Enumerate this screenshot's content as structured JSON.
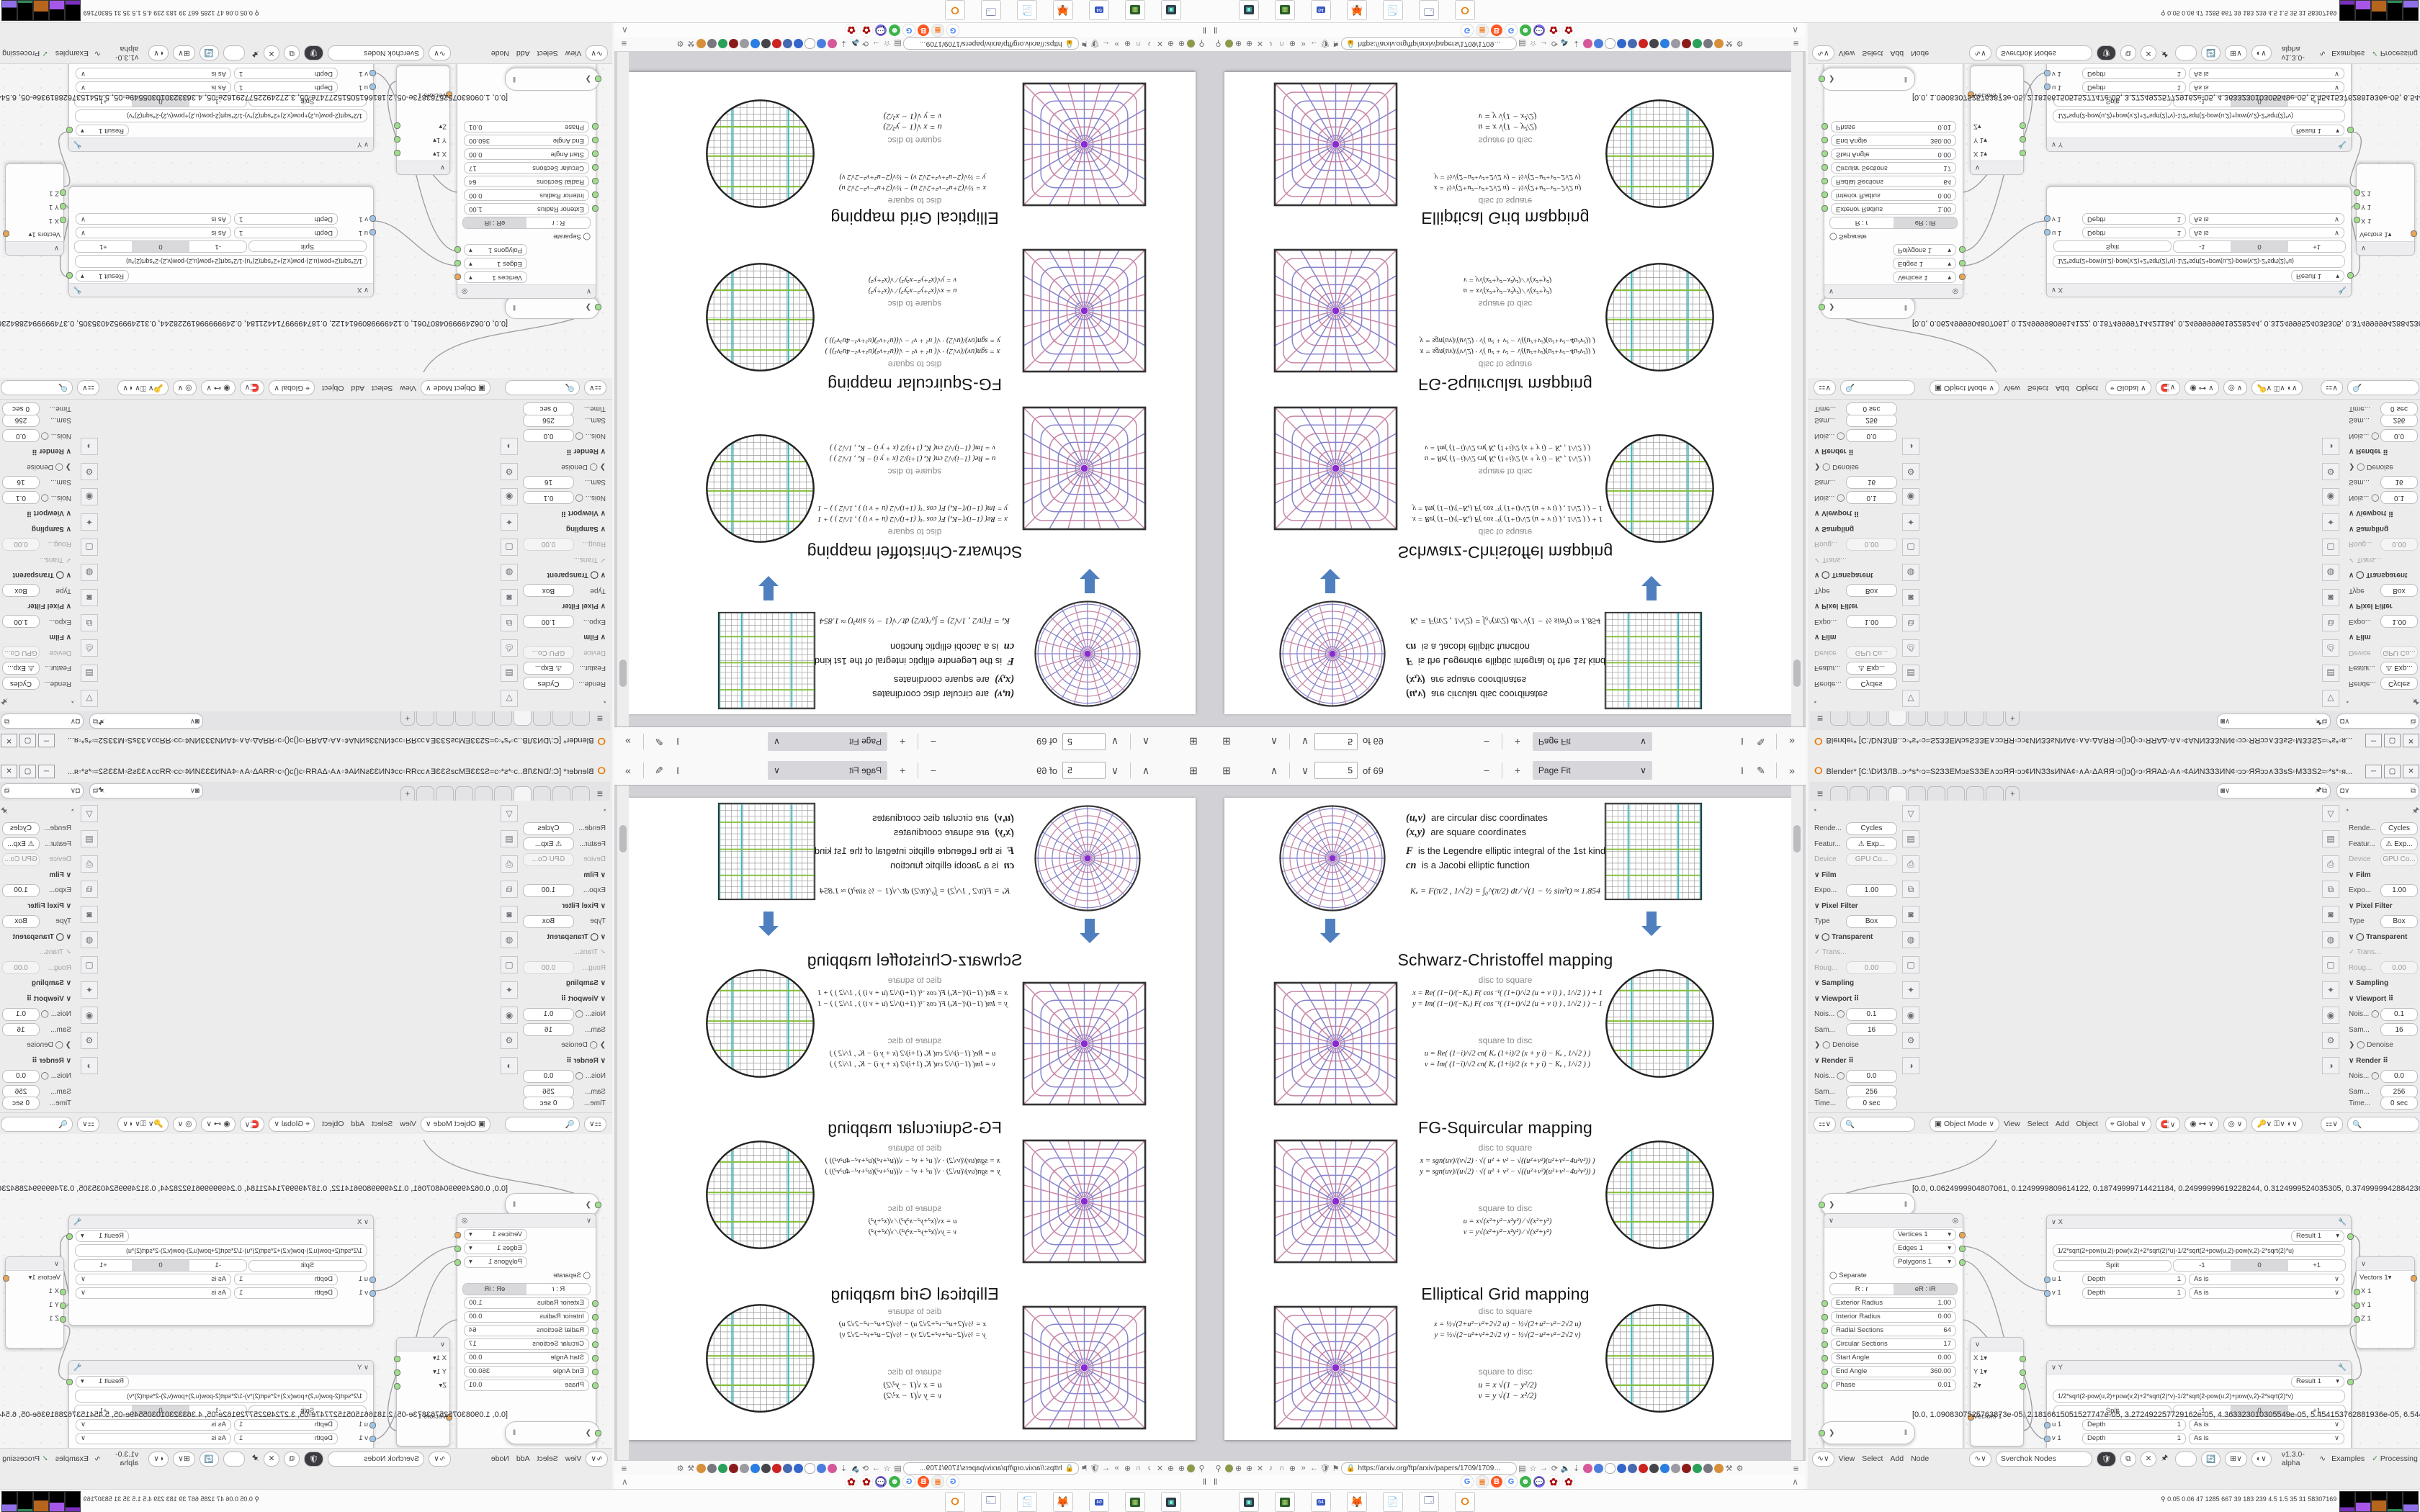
{
  "pdf": {
    "toolbar": {
      "page_value": "5",
      "page_of": "of 69",
      "zoom_label": "Page Fit"
    },
    "page": {
      "legend": [
        {
          "sym": "(u,v)",
          "text": "are circular disc coordinates"
        },
        {
          "sym": "(x,y)",
          "text": "are square coordinates"
        },
        {
          "sym": "F",
          "text": "is the Legendre elliptic integral of the 1st kind"
        },
        {
          "sym": "cn",
          "text": "is a Jacobi elliptic function"
        }
      ],
      "ke_equation": "Kₑ = F(π/2 , 1/√2) = ∫₀^(π/2) dt ∕ √(1 − ½ sin²t)  ≈ 1.854",
      "sections": [
        {
          "title": "Schwarz-Christoffel mapping",
          "d2s_label": "disc to square",
          "s2d_label": "square to disc",
          "eq1": "x = Re( (1−i)/(−Kₑ) F( cos⁻¹( (1+i)/√2 (u + v i) ) , 1/√2 ) ) + 1",
          "eq2": "y = Im( (1−i)/(−Kₑ) F( cos⁻¹( (1+i)/√2 (u + v i) ) , 1/√2 ) ) − 1",
          "eq3": "u = Re( (1−i)/√2 cn( Kₑ (1+i)/2 (x + y i) − Kₑ , 1/√2 ) )",
          "eq4": "v = Im( (1−i)/√2 cn( Kₑ (1+i)/2 (x + y i) − Kₑ , 1/√2 ) )"
        },
        {
          "title": "FG-Squircular mapping",
          "d2s_label": "disc to square",
          "s2d_label": "square to disc",
          "eq1": "x = sgn(uv)/(v√2) · √( u² + v² − √((u²+v²)(u²+v²−4u²v²)) )",
          "eq2": "y = sgn(uv)/(u√2) · √( u² + v² − √((u²+v²)(u²+v²−4u²v²)) )",
          "eq3": "u = x√(x²+y²−x²y²) ∕ √(x²+y²)",
          "eq4": "v = y√(x²+y²−x²y²) ∕ √(x²+y²)"
        },
        {
          "title": "Elliptical Grid mapping",
          "d2s_label": "disc to square",
          "s2d_label": "square to disc",
          "eq1": "x = ½√(2+u²−v²+2√2 u) − ½√(2+u²−v²−2√2 u)",
          "eq2": "y = ½√(2−u²+v²+2√2 v) − ½√(2−u²+v²−2√2 v)",
          "eq3": "u = x √(1 − y²/2)",
          "eq4": "v = y √(1 − x²/2)"
        }
      ]
    },
    "navbar": {
      "url": "https://arxiv.org/ftp/arxiv/papers/1709/1709…"
    }
  },
  "blender": {
    "title": "Blender* [C:\\DИЗЛВ..ɔ◦*ѕ*◦ɔ≈S2ЗЗEМɔƨЅЗЗE∧ɔɔЯЯ◦ɔɔ¢ИΝЗЗѕИΝΑ¢◦∧Α◦ΔΑЯЯ◦ɔ()ɔ()◦ɔ◦ЯЯΑΔ◦Α∧◦¢ΑИΝЗЗЗИΝ¢◦ɔɔ◦ЯЯɔɔ∧ЗЗѕЅ◦МЗЗЅ2≈◦*ѕ*◦я...",
    "props": {
      "rows": [
        {
          "label": "Rende...",
          "value": "Cycles"
        },
        {
          "label": "Featur...",
          "value": "⚠ Exp..."
        },
        {
          "label": "Device",
          "value": "GPU Co..."
        },
        {
          "label": "∨ Film",
          "value": ""
        },
        {
          "label": "Expo...",
          "value": "1.00"
        },
        {
          "label": "∨ Pixel Filter",
          "value": ""
        },
        {
          "label": "Type",
          "value": "Box"
        },
        {
          "label": "∨ ◯ Transparent",
          "value": ""
        },
        {
          "label": "✓ Trans...",
          "value": ""
        },
        {
          "label": "Roug...",
          "value": "0.00"
        },
        {
          "label": "∨ Sampling",
          "value": ""
        },
        {
          "label": "∨ Viewport  ⠿",
          "value": ""
        },
        {
          "label": "Nois... ◯",
          "value": "0.1"
        },
        {
          "label": "Sam...",
          "value": "16"
        },
        {
          "label": "❯ ◯ Denoise",
          "value": ""
        },
        {
          "label": "∨ Render  ⠿",
          "value": ""
        },
        {
          "label": "Nois... ◯",
          "value": "0.0"
        },
        {
          "label": "Sam...",
          "value": "256"
        },
        {
          "label": "Time...",
          "value": "0 sec"
        }
      ]
    },
    "viewport": {
      "overlay1": "Top Orthographic",
      "overlay2": "(2) Scene Collection | ◎ ▦◌◯◌◯◎◌◯◌▦ ◎",
      "stats": [
        {
          "k": "Objects",
          "v": "0 / 53"
        },
        {
          "k": "Vertices",
          "v": "0"
        },
        {
          "k": "Edges",
          "v": "0"
        },
        {
          "k": "Faces",
          "v": "0"
        },
        {
          "k": "Triangles",
          "v": "0"
        }
      ]
    },
    "vp_header": {
      "mode": "Object Mode",
      "menu_view": "View",
      "menu_select": "Select",
      "menu_add": "Add",
      "menu_object": "Object",
      "orientation": "Global"
    },
    "nodes": {
      "array_a": "[0.0, 0.0624999904807061, 0.1249999809614122, 0.18749999714421184, 0.24999999619228244, 0.3124999524035305, 0.37499999428842366, 0.4374999933364912, 0.49999999238456487, 0.562499991432...",
      "array_b": "[0.0, 1.0908307525763873e-05, 2.1816615051527747e-05, 3.272492257729162e-05, 4.363323010305549e-05, 5.454153762881936e-05, 6.544984515458324e-05, 7.635815268034711e-05, 8.7266460...",
      "generator": {
        "out_vertices": "Vertices 1",
        "out_edges": "Edges 1",
        "out_polygons": "Polygons 1",
        "separate": "Separate",
        "toggle_a": "R : r",
        "toggle_b": "eR : iR",
        "fields": [
          {
            "label": "Exterior Radius",
            "value": "1.00"
          },
          {
            "label": "Interior Radius",
            "value": "0.00"
          },
          {
            "label": "Radial Sections",
            "value": "64"
          },
          {
            "label": "Circular Sections",
            "value": "17"
          },
          {
            "label": "Start Angle",
            "value": "0.00"
          },
          {
            "label": "End Angle",
            "value": "360.00"
          },
          {
            "label": "Phase",
            "value": "0.01"
          }
        ]
      },
      "vector_in": {
        "x": "X 1",
        "y": "Y 1",
        "z": "Z",
        "vectors": "Vectors 1"
      },
      "vector_out": {
        "vectors": "Vectors 1",
        "x": "X 1",
        "y": "Y 1",
        "z": "Z 1"
      },
      "formula_x": {
        "name": "X",
        "result": "Result 1",
        "formula": "1/2*sqrt(2+pow(u,2)-pow(v,2)+2*sqrt(2)*u)-1/2*sqrt(2+pow(u,2)-pow(v,2)-2*sqrt(2)*u)"
      },
      "formula_y": {
        "name": "Y",
        "result": "Result 1",
        "formula": "1/2*sqrt(2-pow(u,2)+pow(v,2)+2*sqrt(2)*v)-1/2*sqrt(2-pow(u,2)+pow(v,2)-2*sqrt(2)*v)"
      },
      "shared": {
        "split": "Split",
        "seg1": "-1",
        "seg2": "0",
        "seg3": "+1",
        "u_label": "u 1",
        "v_label": "v 1",
        "depth_label": "Depth",
        "depth_value": "1",
        "mode_label": "As is"
      }
    },
    "nodebar": {
      "menu_view": "View",
      "menu_select": "Select",
      "menu_add": "Add",
      "menu_node": "Node",
      "tree_name": "Sverchok Nodes",
      "version": "v1.3.0-alpha",
      "examples": "Examples",
      "processing": "Processing"
    }
  },
  "taskbar": {
    "systray_text": "0.05 0.06   47   1285 667   39   183 239   4.5   1.5   35   31   58307169",
    "floppy_label": "64"
  },
  "icons": {
    "sidebar": "⊞",
    "chev_up": "∧",
    "chev_down": "∨",
    "minus": "−",
    "plus": "+",
    "text_select": "I",
    "pencil": "✎",
    "more": "»",
    "hamburger": "≡",
    "win_min": "─",
    "win_max": "▢",
    "win_close": "✕",
    "pause": "‖",
    "caret": "∧",
    "back": "←",
    "menu": "≡"
  },
  "colors": {
    "viewport_blue": "#4a7cc3",
    "grid_yellow": "#d9e14c",
    "cyan_line": "#37b9be",
    "green_line": "#86bf3e",
    "arrow_blue": "#4f7fbf"
  }
}
